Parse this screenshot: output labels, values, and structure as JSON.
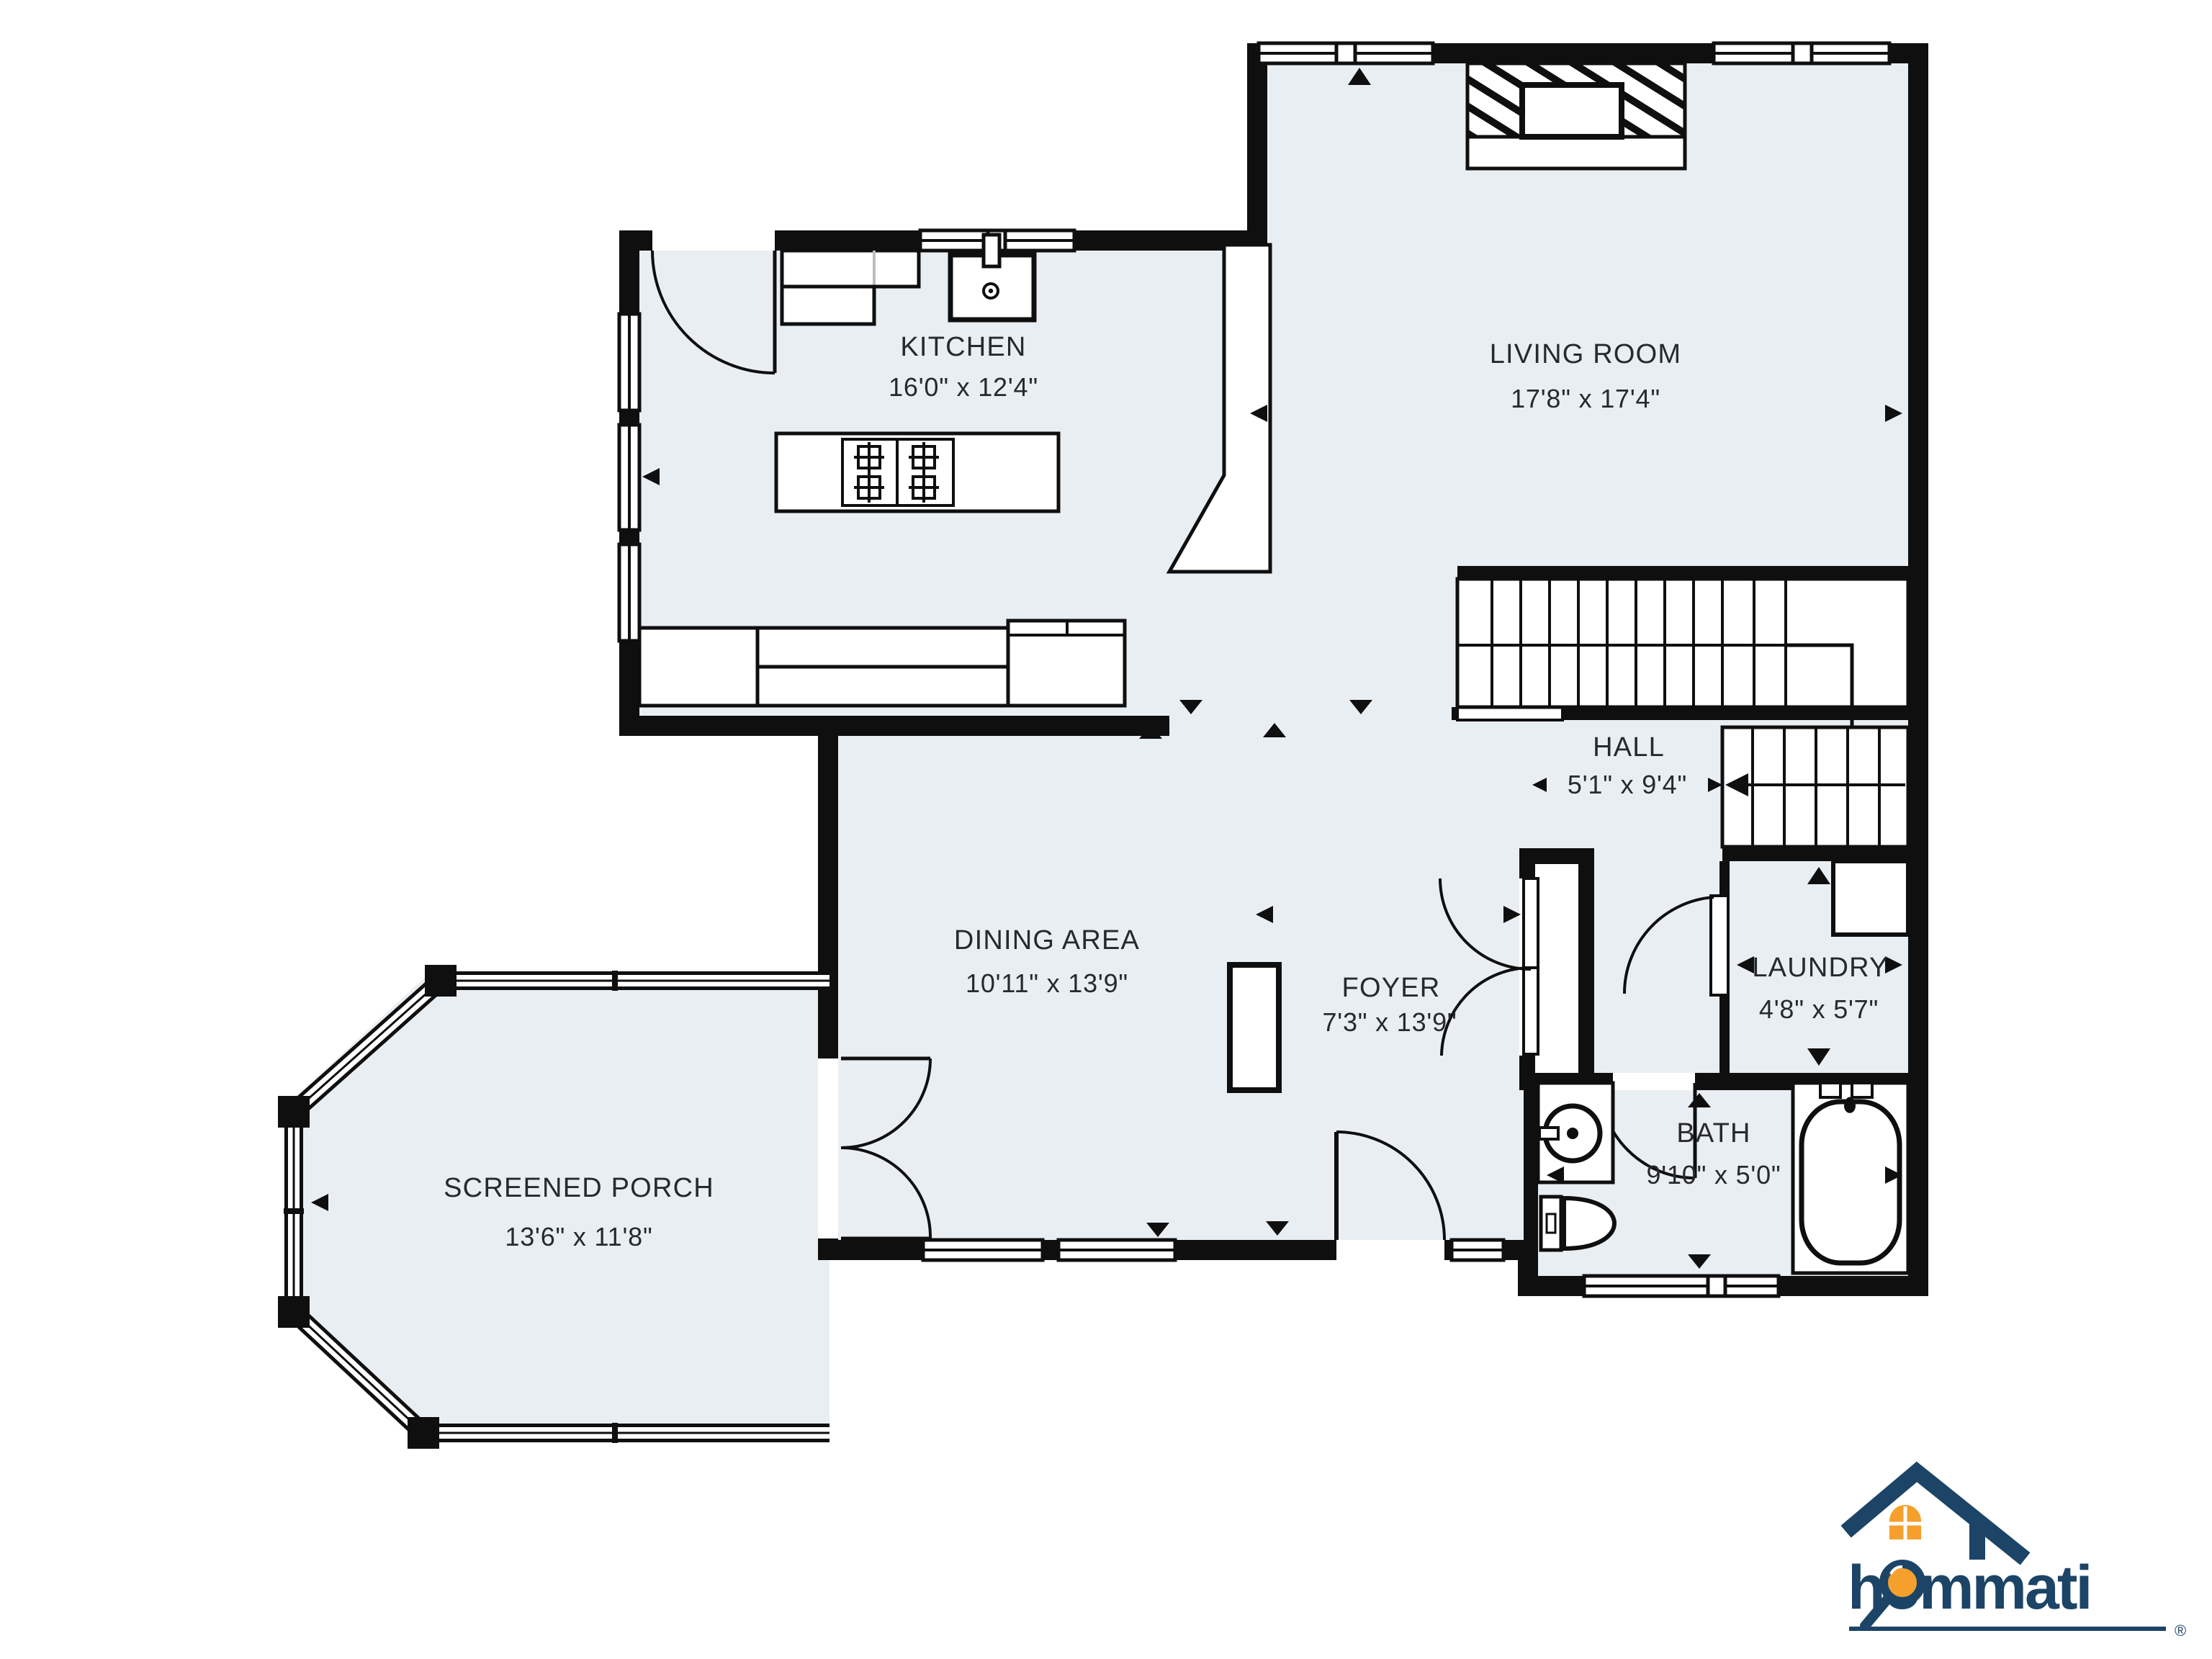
{
  "plan": {
    "title": "first-floor floor plan",
    "rooms": {
      "kitchen": {
        "name": "KITCHEN",
        "dims": "16'0\" x 12'4\""
      },
      "living": {
        "name": "LIVING ROOM",
        "dims": "17'8\" x 17'4\""
      },
      "hall": {
        "name": "HALL",
        "dims": "5'1\" x 9'4\""
      },
      "dining": {
        "name": "DINING AREA",
        "dims": "10'11\" x 13'9\""
      },
      "foyer": {
        "name": "FOYER",
        "dims": "7'3\" x 13'9\""
      },
      "laundry": {
        "name": "LAUNDRY",
        "dims": "4'8\" x 5'7\""
      },
      "bath": {
        "name": "BATH",
        "dims": "9'10\" x 5'0\""
      },
      "porch": {
        "name": "SCREENED PORCH",
        "dims": "13'6\" x 11'8\""
      }
    },
    "icons": {
      "fireplace": "fireplace-hatched-masonry",
      "stove": "four-burner-cooktop",
      "kitchen_sink": "single-basin-sink",
      "bath_sink": "round-basin-vanity",
      "toilet": "toilet",
      "bathtub": "bathtub",
      "stairs_up": "staircase-with-landing",
      "stairs_down": "staircase-to-basement"
    },
    "colors": {
      "room_fill": "#E9EEF2",
      "wall": "#0F0F10",
      "label_text": "#26292D",
      "logo_navy": "#1C4467",
      "logo_orange": "#F5A02C"
    }
  },
  "logo": {
    "brand": "hommati",
    "registered": "®"
  }
}
